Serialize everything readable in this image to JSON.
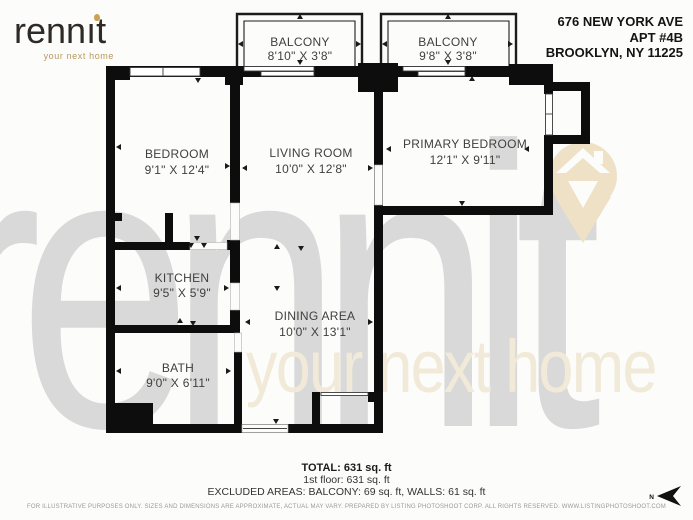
{
  "header": {
    "logo": {
      "word_prefix": "renn",
      "word_i": "ı",
      "word_suffix": "t",
      "tagline": "your next home"
    },
    "address_line1": "676 NEW YORK AVE",
    "address_line2": "APT #4B",
    "address_line3": "BROOKLYN, NY 11225"
  },
  "watermark": {
    "brand": "rennit",
    "tagline": "your next home"
  },
  "rooms": [
    {
      "name": "BALCONY",
      "dims": "8'10\" X 3'8\""
    },
    {
      "name": "BALCONY",
      "dims": "9'8\" X 3'8\""
    },
    {
      "name": "BEDROOM",
      "dims": "9'1\" X 12'4\""
    },
    {
      "name": "LIVING ROOM",
      "dims": "10'0\" X 12'8\""
    },
    {
      "name": "PRIMARY BEDROOM",
      "dims": "12'1\" X 9'11\""
    },
    {
      "name": "KITCHEN",
      "dims": "9'5\" X 5'9\""
    },
    {
      "name": "DINING AREA",
      "dims": "10'0\" X 13'1\""
    },
    {
      "name": "BATH",
      "dims": "9'0\" X 6'11\""
    }
  ],
  "summary": {
    "total": "TOTAL: 631 sq. ft",
    "floor": "1st floor: 631 sq. ft",
    "excluded": "EXCLUDED AREAS: BALCONY: 69 sq. ft, WALLS: 61 sq. ft"
  },
  "compass": {
    "label": "N"
  },
  "footer": {
    "disclaimer": "FOR ILLUSTRATIVE PURPOSES ONLY. SIZES AND DIMENSIONS ARE APPROXIMATE, ACTUAL MAY VARY. PREPARED BY LISTING PHOTOSHOOT CORP. ALL RIGHTS RESERVED. WWW.LISTINGPHOTOSHOOT.COM"
  },
  "colors": {
    "wall": "#0d0d0d",
    "accent_gold": "#b6995c",
    "watermark_gray": "#d9d9d9",
    "watermark_tan": "#f2ead8",
    "pin_tan": "#eee1c6"
  }
}
